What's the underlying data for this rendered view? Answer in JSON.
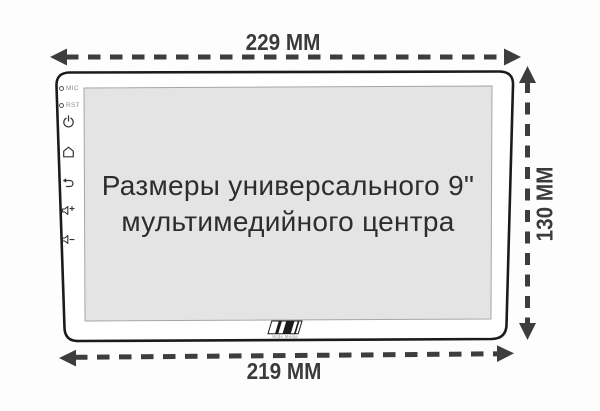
{
  "diagram": {
    "title": {
      "line1": "Размеры универсального 9\"",
      "line2": "мультимедийного центра"
    },
    "dimensions": {
      "top_width": "229 ММ",
      "bottom_width": "219 ММ",
      "side_height": "130 ММ"
    },
    "bezel": {
      "mic_label": "MIC",
      "rst_label": "RST",
      "brand": "Wide Media"
    },
    "colors": {
      "outline": "#1b1b1b",
      "screen_fill": "#e4e4e4",
      "screen_border": "#a6a6a6",
      "dimension_ink": "#3d3d3d",
      "background": "#fdfdfd"
    }
  }
}
